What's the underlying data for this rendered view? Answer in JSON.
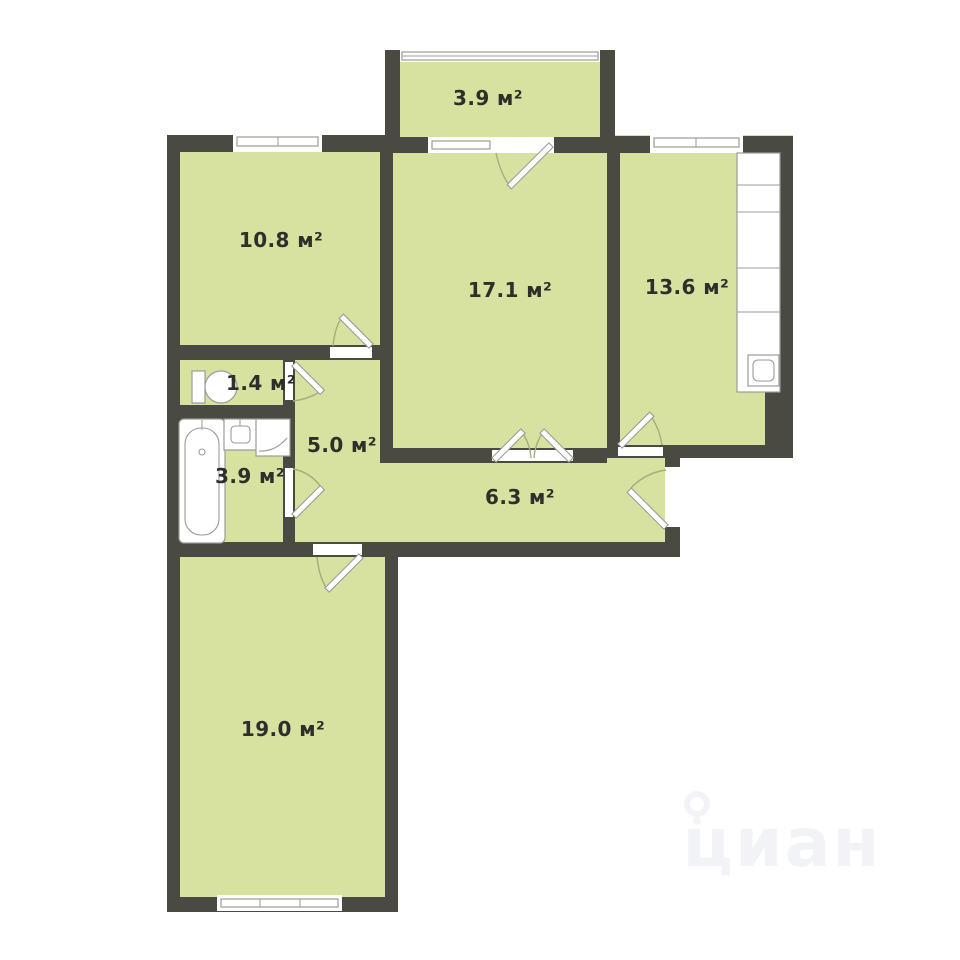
{
  "plan": {
    "title": "apartment-floor-plan",
    "rooms": [
      {
        "id": "loggia",
        "area": "3.9 м²"
      },
      {
        "id": "bedroom",
        "area": "10.8 м²"
      },
      {
        "id": "living-room",
        "area": "17.1 м²"
      },
      {
        "id": "kitchen",
        "area": "13.6 м²"
      },
      {
        "id": "wc",
        "area": "1.4 м²"
      },
      {
        "id": "hall",
        "area": "5.0 м²"
      },
      {
        "id": "bathroom",
        "area": "3.9 м²"
      },
      {
        "id": "corridor",
        "area": "6.3 м²"
      },
      {
        "id": "bedroom-2",
        "area": "19.0 м²"
      }
    ],
    "watermark": {
      "text": "циан"
    },
    "colors": {
      "wall": "#4a4a42",
      "floor": "#d7e2a0",
      "background": "#ffffff",
      "fixture": "#9b9b97",
      "arc": "#a3ad7d",
      "label": "#2e2e2b",
      "watermark": "#f2f3f6"
    }
  }
}
